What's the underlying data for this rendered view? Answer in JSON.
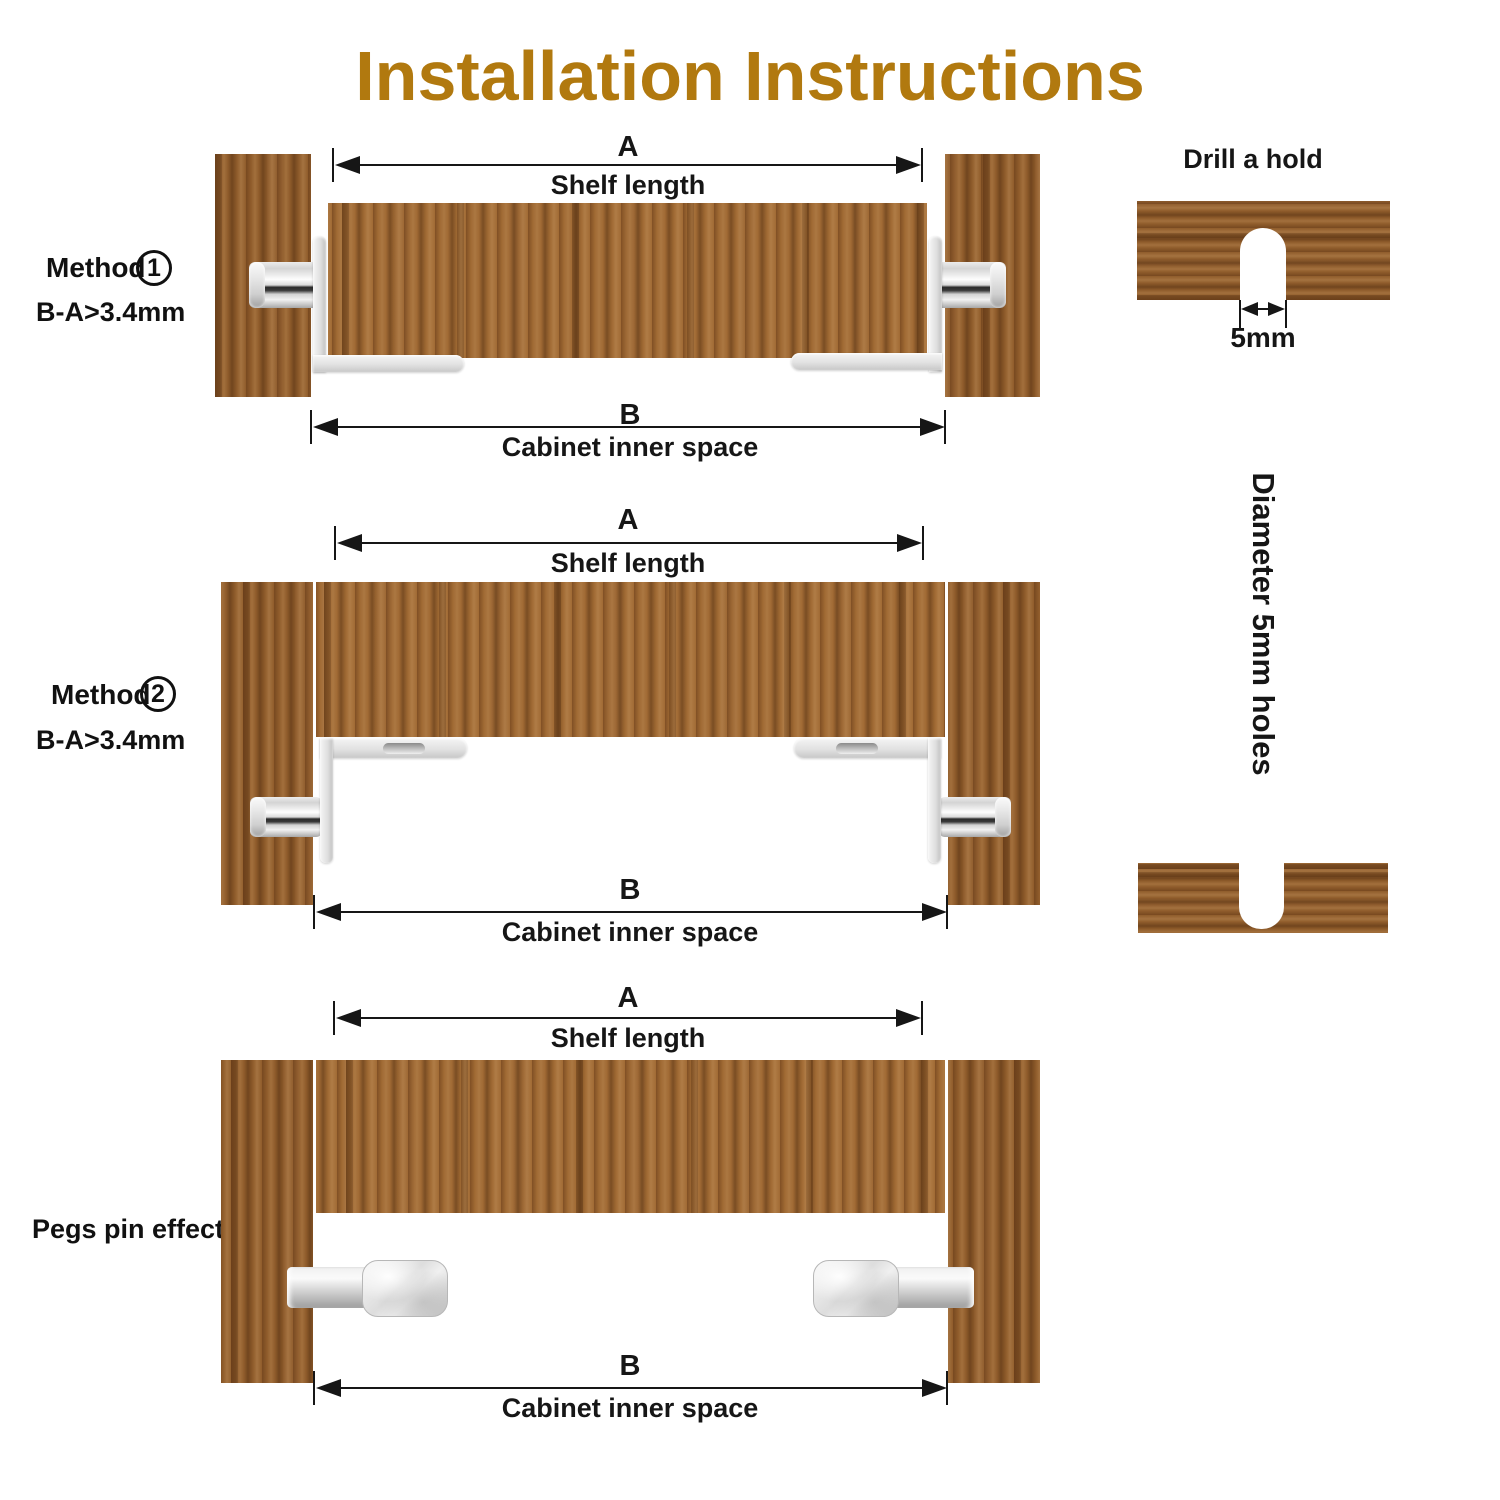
{
  "title": "Installation Instructions",
  "colors": {
    "title": "#b1790f",
    "text": "#1a1a1a",
    "wood_base": "#99642f",
    "metal": "#d9d9d9"
  },
  "diagrams": {
    "method1": {
      "label": "Method",
      "number": "1",
      "note": "B-A>3.4mm",
      "top_dim": {
        "letter": "A",
        "label": "Shelf length"
      },
      "bottom_dim": {
        "letter": "B",
        "label": "Cabinet inner space"
      }
    },
    "method2": {
      "label": "Method",
      "number": "2",
      "note": "B-A>3.4mm",
      "top_dim": {
        "letter": "A",
        "label": "Shelf length"
      },
      "bottom_dim": {
        "letter": "B",
        "label": "Cabinet inner space"
      }
    },
    "pegs_effect": {
      "label": "Pegs pin effect",
      "top_dim": {
        "letter": "A",
        "label": "Shelf length"
      },
      "bottom_dim": {
        "letter": "B",
        "label": "Cabinet inner space"
      }
    }
  },
  "side_panel": {
    "drill_title": "Drill a hold",
    "hole_width": "5mm",
    "diameter_note": "Diameter 5mm holes"
  }
}
